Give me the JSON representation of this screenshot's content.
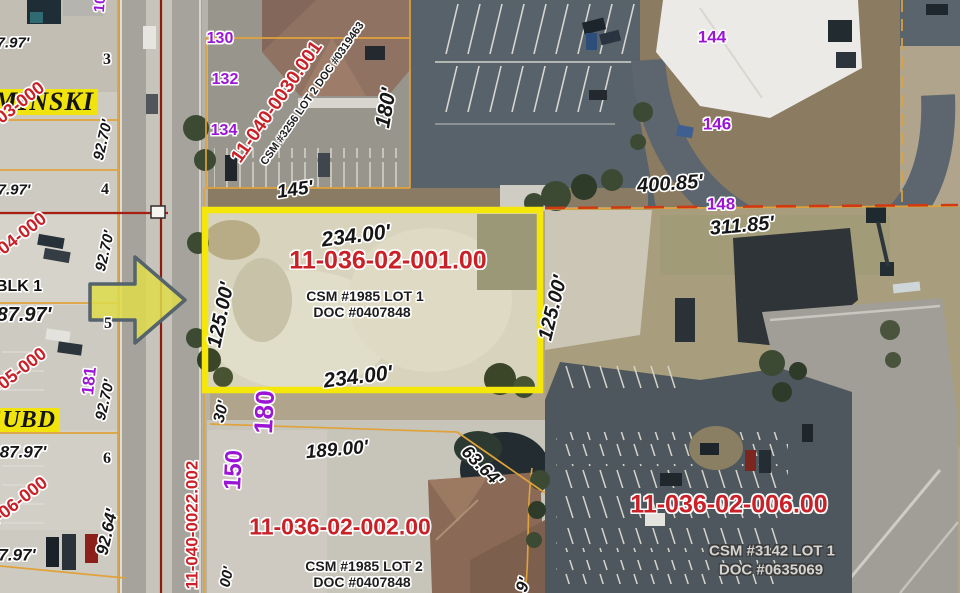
{
  "map": {
    "type": "annotated-aerial-parcel-map",
    "highlight_parcel": {
      "parcel_id": "11-036-02-001.00",
      "survey": "CSM #1985 LOT 1",
      "document": "DOC #0407848",
      "frontage": "234.00'",
      "depth": "125.00'"
    },
    "colors": {
      "highlight_outline": "#f6e70a",
      "pointer_arrow_fill": "#dedc4a",
      "pointer_arrow_stroke": "#55636d",
      "parcel_id_red": "#c92127",
      "address_purple": "#9a16d4",
      "boundary_orange": "#e0a23a",
      "centerline_red": "#8e1b10"
    },
    "labels": [
      {
        "t": "MINSKI",
        "x": 44,
        "y": 102,
        "r": 0,
        "c": "town",
        "s": 26
      },
      {
        "t": "7.97'",
        "x": 13,
        "y": 43,
        "r": 0,
        "c": "dim",
        "s": 15
      },
      {
        "t": "3",
        "x": 107,
        "y": 60,
        "r": 0,
        "c": "num",
        "s": 16
      },
      {
        "t": "11-03-000",
        "x": 10,
        "y": 110,
        "r": -38,
        "c": "red",
        "s": 18
      },
      {
        "t": "92.70'",
        "x": 103,
        "y": 140,
        "r": -77,
        "c": "dim",
        "s": 15
      },
      {
        "t": "7.97'",
        "x": 14,
        "y": 190,
        "r": 0,
        "c": "dim",
        "s": 15
      },
      {
        "t": "4",
        "x": 105,
        "y": 190,
        "r": 0,
        "c": "num",
        "s": 16
      },
      {
        "t": "11-04-000",
        "x": 12,
        "y": 241,
        "r": -38,
        "c": "red",
        "s": 18
      },
      {
        "t": "92.70'",
        "x": 105,
        "y": 251,
        "r": -77,
        "c": "dim",
        "s": 15
      },
      {
        "t": "BLK 1",
        "x": 19,
        "y": 287,
        "r": 0,
        "c": "blk",
        "s": 16
      },
      {
        "t": "87.97'",
        "x": 24,
        "y": 315,
        "r": 0,
        "c": "dim",
        "s": 20
      },
      {
        "t": "5",
        "x": 108,
        "y": 324,
        "r": 0,
        "c": "num",
        "s": 16
      },
      {
        "t": "11-05-000",
        "x": 12,
        "y": 376,
        "r": -38,
        "c": "red",
        "s": 18
      },
      {
        "t": "181",
        "x": 89,
        "y": 381,
        "r": -84,
        "c": "purple",
        "s": 17
      },
      {
        "t": "92.70'",
        "x": 105,
        "y": 400,
        "r": -77,
        "c": "dim",
        "s": 15
      },
      {
        "t": "SUBD",
        "x": 22,
        "y": 420,
        "r": 0,
        "c": "town",
        "s": 24
      },
      {
        "t": "87.97'",
        "x": 23,
        "y": 452,
        "r": 0,
        "c": "dim",
        "s": 17
      },
      {
        "t": "6",
        "x": 107,
        "y": 459,
        "r": 0,
        "c": "num",
        "s": 16
      },
      {
        "t": "11-06-000",
        "x": 13,
        "y": 505,
        "r": -38,
        "c": "red",
        "s": 18
      },
      {
        "t": "92.64'",
        "x": 107,
        "y": 532,
        "r": -77,
        "c": "dim",
        "s": 17
      },
      {
        "t": "7.97'",
        "x": 17,
        "y": 555,
        "r": 0,
        "c": "dim",
        "s": 17
      },
      {
        "t": "10",
        "x": 100,
        "y": 4,
        "r": -85,
        "c": "purple",
        "s": 15
      },
      {
        "t": "11-040-0022.002",
        "x": 192,
        "y": 525,
        "r": -90,
        "c": "red",
        "s": 17
      },
      {
        "t": "30'",
        "x": 222,
        "y": 412,
        "r": -76,
        "c": "dim",
        "s": 16
      },
      {
        "t": "180",
        "x": 264,
        "y": 412,
        "r": -87,
        "c": "purple",
        "s": 26
      },
      {
        "t": "150",
        "x": 234,
        "y": 470,
        "r": -87,
        "c": "purple",
        "s": 24
      },
      {
        "t": "00'",
        "x": 227,
        "y": 577,
        "r": -78,
        "c": "dim",
        "s": 15
      },
      {
        "t": "130",
        "x": 220,
        "y": 39,
        "r": 0,
        "c": "purple",
        "s": 16
      },
      {
        "t": "132",
        "x": 225,
        "y": 80,
        "r": 0,
        "c": "purple",
        "s": 16
      },
      {
        "t": "134",
        "x": 224,
        "y": 131,
        "r": 0,
        "c": "purple",
        "s": 16
      },
      {
        "t": "11-040-0030.001",
        "x": 277,
        "y": 102,
        "r": -55,
        "c": "red",
        "s": 19
      },
      {
        "t": "CSM #3256 LOT 2 DOC #0319463",
        "x": 313,
        "y": 94,
        "r": -55,
        "c": "blk-sm",
        "s": 11
      },
      {
        "t": "145'",
        "x": 295,
        "y": 190,
        "r": -8,
        "c": "dim",
        "s": 19
      },
      {
        "t": "180'",
        "x": 386,
        "y": 108,
        "r": -80,
        "c": "dim",
        "s": 21
      },
      {
        "t": "144",
        "x": 712,
        "y": 37,
        "r": 0,
        "c": "purple",
        "s": 17
      },
      {
        "t": "146",
        "x": 717,
        "y": 124,
        "r": 0,
        "c": "purple",
        "s": 17
      },
      {
        "t": "148",
        "x": 721,
        "y": 204,
        "r": 0,
        "c": "purple",
        "s": 17
      },
      {
        "t": "400.85'",
        "x": 670,
        "y": 184,
        "r": -4,
        "c": "dim",
        "s": 20
      },
      {
        "t": "234.00'",
        "x": 356,
        "y": 236,
        "r": -7,
        "c": "dim",
        "s": 21
      },
      {
        "t": "11-036-02-001.00",
        "x": 388,
        "y": 261,
        "r": 0,
        "c": "red-lg",
        "s": 25
      },
      {
        "t": "CSM #1985 LOT 1",
        "x": 365,
        "y": 296,
        "r": 0,
        "c": "blk-md",
        "s": 14
      },
      {
        "t": "DOC #0407848",
        "x": 362,
        "y": 312,
        "r": 0,
        "c": "blk-md",
        "s": 14
      },
      {
        "t": "125.00'",
        "x": 221,
        "y": 315,
        "r": -78,
        "c": "dim",
        "s": 20
      },
      {
        "t": "234.00'",
        "x": 358,
        "y": 377,
        "r": -7,
        "c": "dim",
        "s": 21
      },
      {
        "t": "125.00'",
        "x": 553,
        "y": 308,
        "r": -76,
        "c": "dim",
        "s": 20
      },
      {
        "t": "311.85'",
        "x": 742,
        "y": 226,
        "r": -5,
        "c": "dim",
        "s": 20
      },
      {
        "t": "189.00'",
        "x": 337,
        "y": 450,
        "r": -5,
        "c": "dim",
        "s": 19
      },
      {
        "t": "63.64'",
        "x": 482,
        "y": 466,
        "r": 45,
        "c": "dim",
        "s": 18
      },
      {
        "t": "11-036-02-002.00",
        "x": 340,
        "y": 527,
        "r": 0,
        "c": "red-lg",
        "s": 23
      },
      {
        "t": "CSM #1985 LOT 2",
        "x": 364,
        "y": 566,
        "r": 0,
        "c": "blk-md",
        "s": 14
      },
      {
        "t": "DOC #0407848",
        "x": 362,
        "y": 582,
        "r": 0,
        "c": "blk-md",
        "s": 14
      },
      {
        "t": "9'",
        "x": 523,
        "y": 585,
        "r": -72,
        "c": "dim",
        "s": 17
      },
      {
        "t": "11-036-02-006.00",
        "x": 729,
        "y": 505,
        "r": 0,
        "c": "red-lg",
        "s": 25
      },
      {
        "t": "CSM #3142 LOT 1",
        "x": 772,
        "y": 551,
        "r": 0,
        "c": "gray-md",
        "s": 15
      },
      {
        "t": "DOC #0635069",
        "x": 771,
        "y": 570,
        "r": 0,
        "c": "gray-md",
        "s": 15
      }
    ]
  }
}
